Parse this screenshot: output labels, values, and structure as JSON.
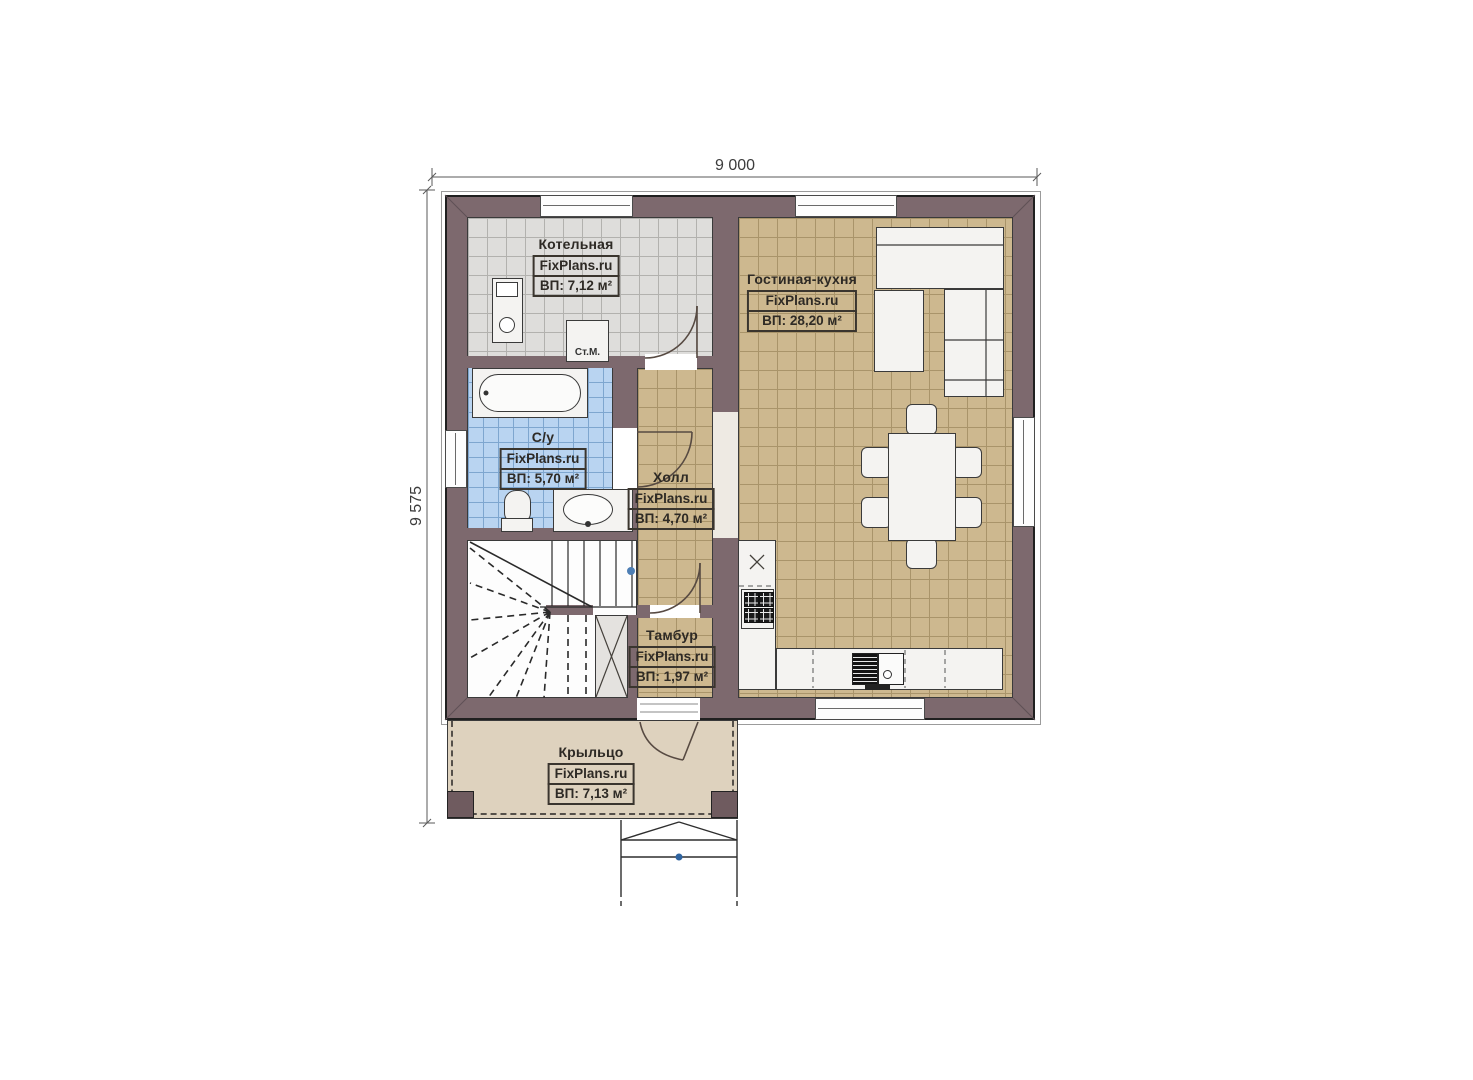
{
  "dimensions": {
    "width": "9 000",
    "height": "9 575"
  },
  "watermark": "FixPlans.ru",
  "rooms": [
    {
      "id": "kotelnaya",
      "name": "Котельная",
      "watermark": "FixPlans.ru",
      "area": "ВП: 7,12 м²"
    },
    {
      "id": "gostinaya",
      "name": "Гостиная-кухня",
      "watermark": "FixPlans.ru",
      "area": "ВП: 28,20 м²"
    },
    {
      "id": "su",
      "name": "С/у",
      "watermark": "FixPlans.ru",
      "area": "ВП: 5,70 м²"
    },
    {
      "id": "holl",
      "name": "Холл",
      "watermark": "FixPlans.ru",
      "area": "ВП: 4,70 м²"
    },
    {
      "id": "tambur",
      "name": "Тамбур",
      "watermark": "FixPlans.ru",
      "area": "ВП: 1,97 м²"
    },
    {
      "id": "kryltso",
      "name": "Крыльцо",
      "watermark": "FixPlans.ru",
      "area": "ВП: 7,13 м²"
    }
  ],
  "fixtures": {
    "washing_machine": "Ст.М."
  },
  "colors": {
    "wall": "#7d696e",
    "floor_tan": "#cdb88f",
    "floor_gray": "#dedddb",
    "floor_blue": "#b9d4f1",
    "porch": "#ded2be",
    "marker_blue": "#2f64a0"
  }
}
